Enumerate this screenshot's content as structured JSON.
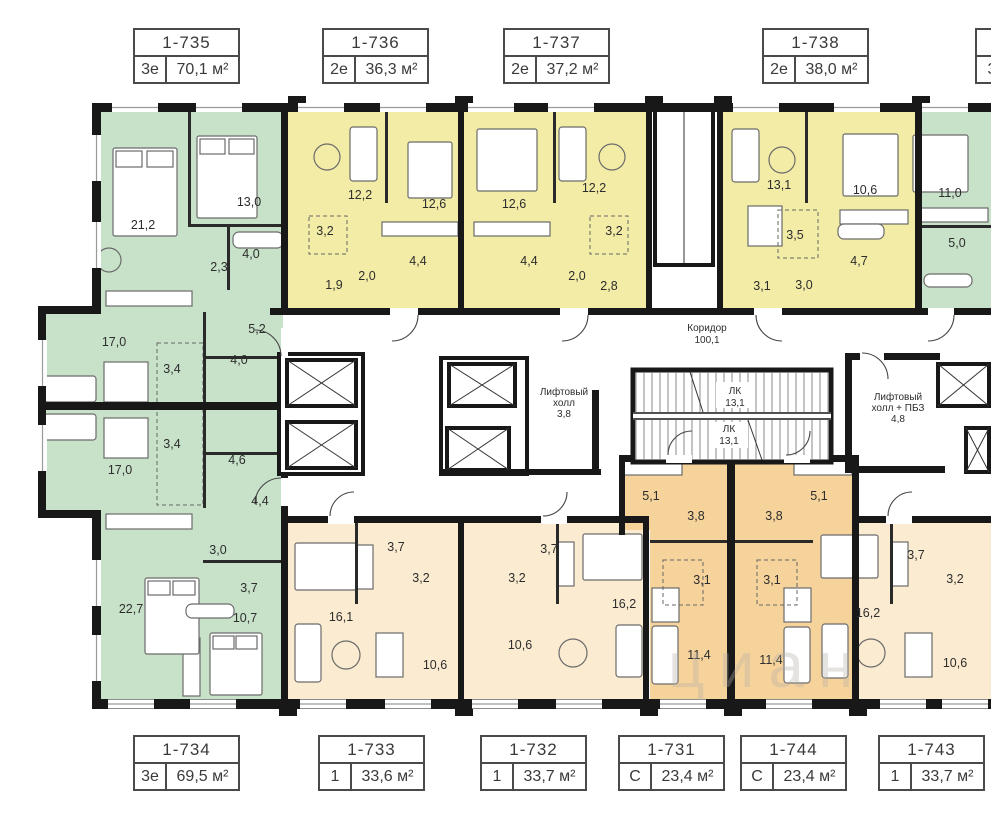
{
  "watermark": "циан",
  "colors": {
    "green": "#c8e2ca",
    "yellow": "#f2eca6",
    "peach": "#fbebd0",
    "orange": "#f7d39c",
    "wall": "#181818"
  },
  "cards": {
    "top": [
      {
        "number": "1-735",
        "type": "3е",
        "area": "70,1 м²"
      },
      {
        "number": "1-736",
        "type": "2е",
        "area": "36,3 м²"
      },
      {
        "number": "1-737",
        "type": "2е",
        "area": "37,2 м²"
      },
      {
        "number": "1-738",
        "type": "2е",
        "area": "38,0 м²"
      },
      {
        "number": "",
        "type": "3",
        "area": ""
      }
    ],
    "bottom": [
      {
        "number": "1-734",
        "type": "3е",
        "area": "69,5 м²"
      },
      {
        "number": "1-733",
        "type": "1",
        "area": "33,6 м²"
      },
      {
        "number": "1-732",
        "type": "1",
        "area": "33,7 м²"
      },
      {
        "number": "1-731",
        "type": "С",
        "area": "23,4 м²"
      },
      {
        "number": "1-744",
        "type": "С",
        "area": "23,4 м²"
      },
      {
        "number": "1-743",
        "type": "1",
        "area": "33,7 м²"
      }
    ]
  },
  "apartments": {
    "a735": {
      "rooms": [
        "21,2",
        "13,0",
        "2,3",
        "4,0",
        "5,2",
        "17,0",
        "3,4",
        "4,0"
      ]
    },
    "a734": {
      "rooms": [
        "17,0",
        "3,4",
        "4,6",
        "4,4",
        "3,0",
        "3,7",
        "22,7",
        "10,7"
      ]
    },
    "a736": {
      "rooms": [
        "12,2",
        "12,6",
        "3,2",
        "1,9",
        "2,0",
        "4,4"
      ]
    },
    "a737": {
      "rooms": [
        "12,6",
        "12,2",
        "3,2",
        "4,4",
        "2,0",
        "2,8"
      ]
    },
    "a738": {
      "rooms": [
        "13,1",
        "10,6",
        "3,5",
        "4,7",
        "3,1",
        "3,0"
      ]
    },
    "a739p": {
      "rooms": [
        "11,0",
        "5,0"
      ]
    },
    "a733": {
      "rooms": [
        "16,1",
        "3,7",
        "3,2",
        "10,6"
      ]
    },
    "a732": {
      "rooms": [
        "16,2",
        "3,7",
        "3,2",
        "10,6"
      ]
    },
    "a731": {
      "rooms": [
        "5,1",
        "3,8",
        "3,1",
        "11,4"
      ]
    },
    "a744": {
      "rooms": [
        "5,1",
        "3,8",
        "3,1",
        "11,4"
      ]
    },
    "a743": {
      "rooms": [
        "16,2",
        "3,7",
        "3,2",
        "10,6"
      ]
    }
  },
  "common": {
    "corridor": {
      "label": "Коридор",
      "area": "100,1"
    },
    "lift_hall": {
      "line1": "Лифтовый",
      "line2": "холл",
      "area": "3,8"
    },
    "stairs_upper": {
      "label": "ЛК",
      "area": "13,1"
    },
    "stairs_lower": {
      "label": "ЛК",
      "area": "13,1"
    },
    "lift_hall_pbz": {
      "line1": "Лифтовый",
      "line2": "холл + ПБЗ",
      "area": "4,8"
    }
  }
}
